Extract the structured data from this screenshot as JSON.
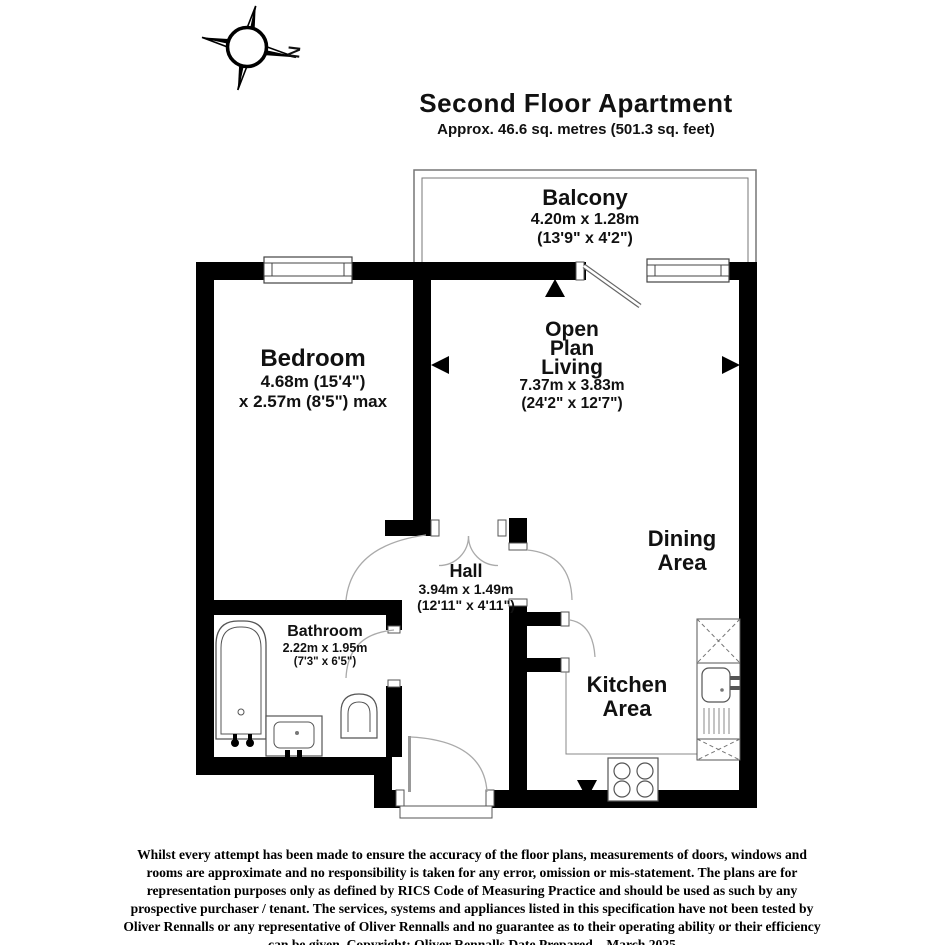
{
  "title": {
    "heading": "Second Floor Apartment",
    "subtitle": "Approx. 46.6 sq. metres (501.3 sq. feet)"
  },
  "compass": {
    "label": "N"
  },
  "rooms": {
    "balcony": {
      "name": "Balcony",
      "dim_metric": "4.20m x 1.28m",
      "dim_imperial": "(13'9\" x 4'2\")"
    },
    "bedroom": {
      "name": "Bedroom",
      "dim_line1": "4.68m (15'4\")",
      "dim_line2": "x 2.57m (8'5\") max"
    },
    "living": {
      "name_line1": "Open",
      "name_line2": "Plan",
      "name_line3": "Living",
      "dim_metric": "7.37m x 3.83m",
      "dim_imperial": "(24'2\" x 12'7\")"
    },
    "dining": {
      "name_line1": "Dining",
      "name_line2": "Area"
    },
    "hall": {
      "name": "Hall",
      "dim_metric": "3.94m x 1.49m",
      "dim_imperial": "(12'11\" x 4'11\")"
    },
    "bathroom": {
      "name": "Bathroom",
      "dim_metric": "2.22m x 1.95m",
      "dim_imperial": "(7'3\" x 6'5\")"
    },
    "kitchen": {
      "name_line1": "Kitchen",
      "name_line2": "Area"
    }
  },
  "disclaimer": "Whilst every attempt has been made to ensure the accuracy of the floor plans, measurements of doors, windows and rooms are approximate and no responsibility is taken for any error, omission or mis-statement. The plans are for representation purposes only as defined by RICS Code of Measuring Practice and should be used as such by any prospective purchaser / tenant. The services, systems and appliances listed in this specification have not been tested by Oliver Rennalls or any representative of Oliver Rennalls and no guarantee as to their operating ability or their efficiency can be given. Copyright: Oliver Rennalls Date Prepared – March 2025",
  "colors": {
    "wall": "#000000",
    "background": "#ffffff",
    "fixture_outline": "#555555",
    "door_arc": "#aaaaaa",
    "text": "#111111"
  }
}
